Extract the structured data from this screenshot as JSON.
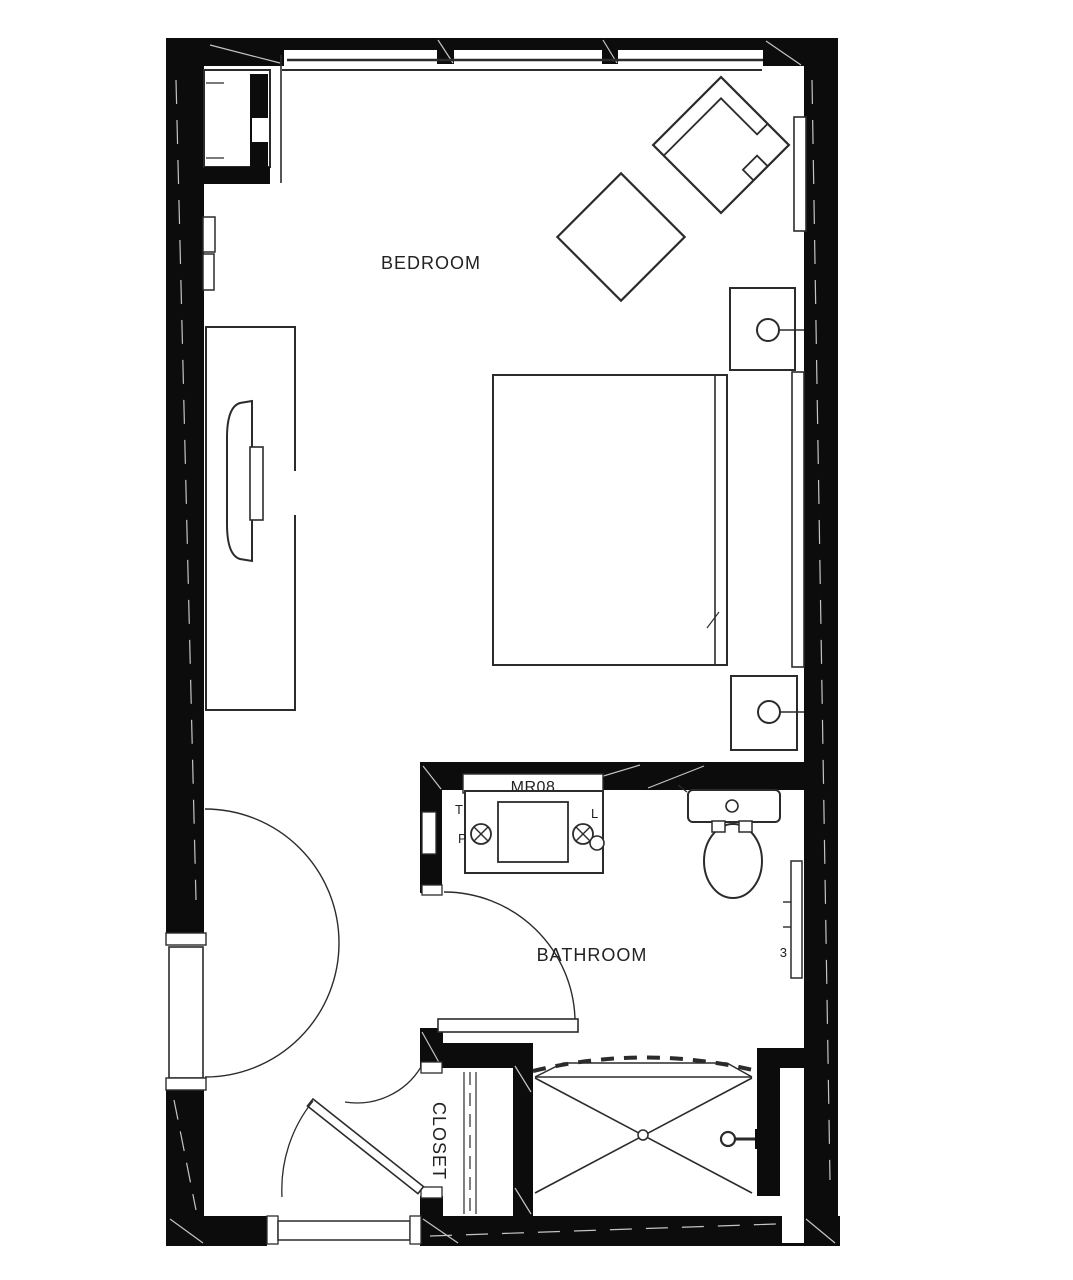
{
  "plan": {
    "title": "hotel-room-floor-plan",
    "labels": {
      "bedroom": "BEDROOM",
      "bathroom": "BATHROOM",
      "closet": "CLOSET",
      "room_tag": "MR08",
      "tag_t": "T",
      "tag_p": "P",
      "tag_l": "L",
      "tag_3": "3"
    },
    "colors": {
      "wall": "#0c0c0c",
      "line": "#2b2b2b",
      "hatch": "#c4c4c4",
      "background": "#ffffff"
    },
    "fixtures": [
      "window",
      "entry-door",
      "wardrobe-cabinet",
      "media-console",
      "tv",
      "bed",
      "headboard-panel",
      "nightstand",
      "table-lamp",
      "lounge-chair",
      "side-table",
      "wall-shelf",
      "vanity",
      "sink",
      "wall-sconce",
      "toilet",
      "grab-bar",
      "bathroom-door",
      "closet-door",
      "closet-rod",
      "bathtub-shower",
      "shower-curtain",
      "shower-head",
      "communicating-door"
    ]
  }
}
